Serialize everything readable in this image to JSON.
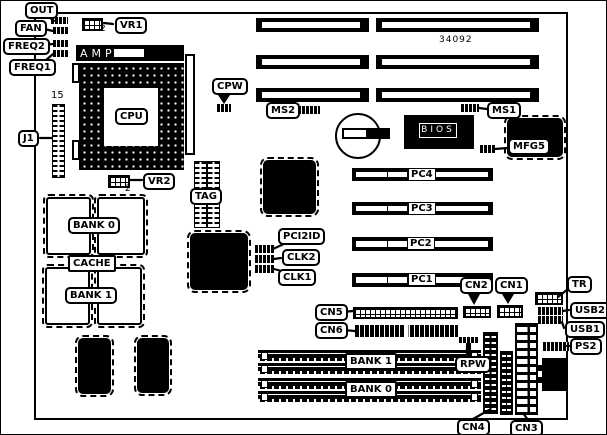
{
  "board": {
    "part_number": "34092",
    "labels": {
      "out": "OUT",
      "fan": "FAN",
      "freq2": "FREQ2",
      "freq1": "FREQ1",
      "vr1": "VR1",
      "vr1_pin": "2",
      "amp": "AMP",
      "cpu": "CPU",
      "pin15": "15",
      "j1": "J1",
      "vr2": "VR2",
      "vr2_pin": "2",
      "cpw": "CPW",
      "ms2": "MS2",
      "ms1": "MS1",
      "bios": "BIOS",
      "mfg5": "MFG5",
      "tag": "TAG",
      "cache_bank0": "BANK 0",
      "cache": "CACHE",
      "cache_bank1": "BANK 1",
      "pci2id": "PCI2ID",
      "clk2": "CLK2",
      "clk1": "CLK1",
      "pc4": "PC4",
      "pc3": "PC3",
      "pc2": "PC2",
      "pc1": "PC1",
      "cn5": "CN5",
      "cn6": "CN6",
      "cn2": "CN2",
      "cn1": "CN1",
      "tr": "TR",
      "usb2": "USB2",
      "usb1": "USB1",
      "ps2": "PS2",
      "rpw": "RPW",
      "simm_bank1": "BANK 1",
      "simm_bank0": "BANK 0",
      "cn4": "CN4",
      "cn3": "CN3"
    },
    "colors": {
      "ink": "#000000",
      "paper": "#ffffff"
    }
  }
}
